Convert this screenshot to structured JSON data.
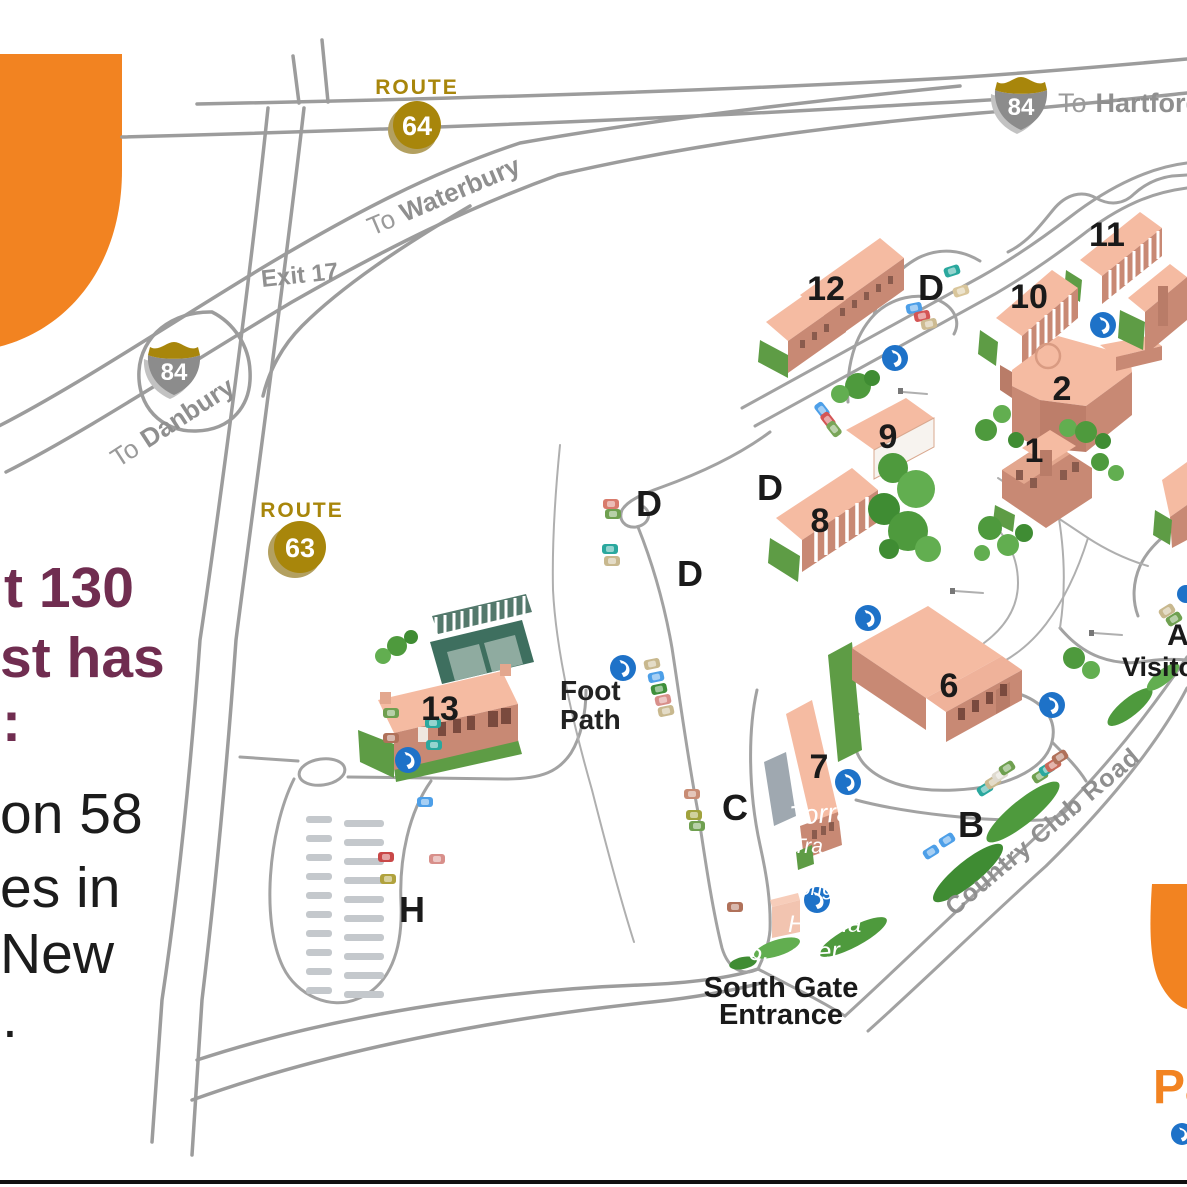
{
  "colors": {
    "accent_orange": "#F28321",
    "route_gold": "#A8860B",
    "road_gray": "#9C9C9C",
    "building_top": "#F5BBA2",
    "building_side": "#C88974",
    "grass_green": "#5E9C45",
    "phone_blue": "#1E72C8",
    "sidebar_purple": "#702D50"
  },
  "highways": {
    "route64": {
      "word": "ROUTE",
      "number": "64"
    },
    "route63": {
      "word": "ROUTE",
      "number": "63"
    },
    "i84_north": {
      "number": "84",
      "to_word": "To",
      "city": "Hartford"
    },
    "i84_south": {
      "number": "84",
      "to_word": "To",
      "city": "Danbury"
    },
    "waterbury": {
      "to_word": "To",
      "city": "Waterbury"
    },
    "exit_label": "Exit 17"
  },
  "map_labels": {
    "foot_path_line1": "Foot",
    "foot_path_line2": "Path",
    "south_gate_line1": "South Gate",
    "south_gate_line2": "Entrance",
    "road_name": "Country Club Road",
    "visitor_letter": "A",
    "visitor_word": "Visito",
    "bottom_right_partial": "Pa"
  },
  "buildings": [
    {
      "number": "12"
    },
    {
      "number": "11"
    },
    {
      "number": "10"
    },
    {
      "number": "2"
    },
    {
      "number": "1"
    },
    {
      "number": "9"
    },
    {
      "number": "8"
    },
    {
      "number": "6"
    },
    {
      "number": "7"
    },
    {
      "number": "13"
    }
  ],
  "parking": [
    {
      "letter": "D"
    },
    {
      "letter": "D"
    },
    {
      "letter": "D"
    },
    {
      "letter": "D"
    },
    {
      "letter": "B"
    },
    {
      "letter": "C"
    },
    {
      "letter": "H"
    }
  ],
  "white_annotations": [
    {
      "text": "Torra"
    },
    {
      "text": "Tra"
    },
    {
      "text": "ong"
    },
    {
      "text": "Hei Ha"
    },
    {
      "text": "6."
    },
    {
      "text": "ever"
    }
  ],
  "sidebar": {
    "fragments": [
      {
        "text": "t 130"
      },
      {
        "text": "st has"
      },
      {
        "text": ":"
      },
      {
        "text": "on 58"
      },
      {
        "text": "es in"
      },
      {
        "text": "New"
      },
      {
        "text": "."
      }
    ]
  }
}
